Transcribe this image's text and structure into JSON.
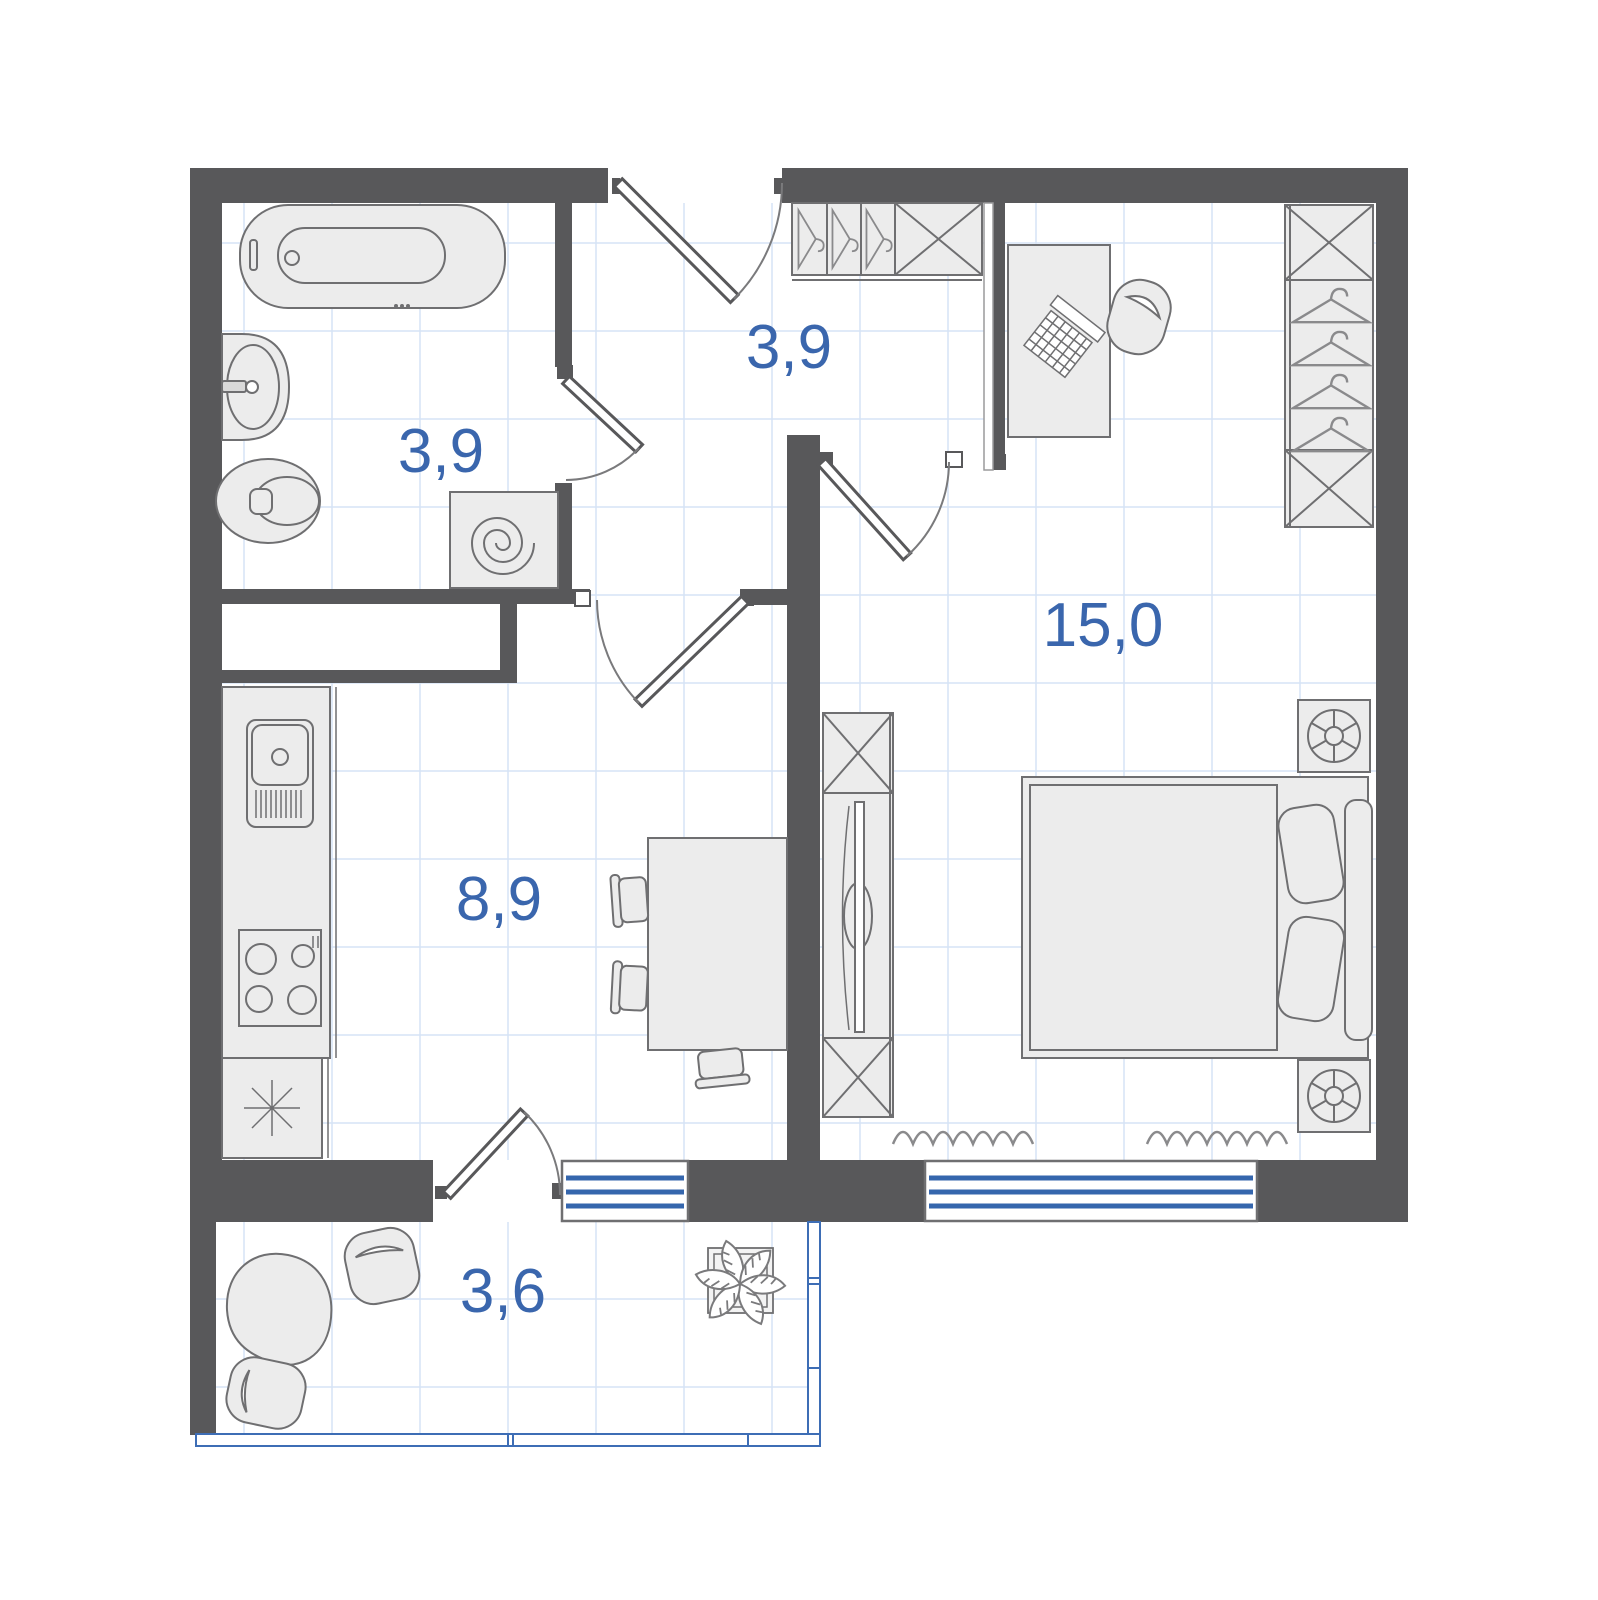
{
  "plan": {
    "type": "apartment-floor-plan",
    "rooms": [
      {
        "name": "bathroom",
        "area": "3,9"
      },
      {
        "name": "hallway",
        "area": "3,9"
      },
      {
        "name": "bedroom",
        "area": "15,0"
      },
      {
        "name": "kitchen-living",
        "area": "8,9"
      },
      {
        "name": "balcony",
        "area": "3,6"
      }
    ],
    "colors": {
      "wall": "#58585a",
      "area_label": "#3a66ad",
      "window_glass": "#3566ad",
      "balcony_glazing": "#3d6db5",
      "furniture_fill": "#ececec",
      "furniture_stroke": "#6f6f71",
      "tile_grid": "#d6e3f5",
      "floor": "#ffffff"
    },
    "furniture_icons": [
      "bathtub-icon",
      "wash-basin-icon",
      "toilet-icon",
      "washing-machine-icon",
      "entry-door-icon",
      "interior-door-icon",
      "wardrobe-hangers-icon",
      "storage-x-box-icon",
      "desk-icon",
      "laptop-icon",
      "office-chair-icon",
      "closet-hangers-icon",
      "double-bed-icon",
      "pillow-icon",
      "nightstand-lamp-icon",
      "tv-stand-icon",
      "tv-icon",
      "kitchen-sink-icon",
      "stove-icon",
      "fridge-icon",
      "dining-table-icon",
      "chair-icon",
      "radiator-icon",
      "window-icon",
      "beanbag-icon",
      "pouf-icon",
      "plant-icon"
    ],
    "windows": {
      "stripe_count": 3
    }
  }
}
